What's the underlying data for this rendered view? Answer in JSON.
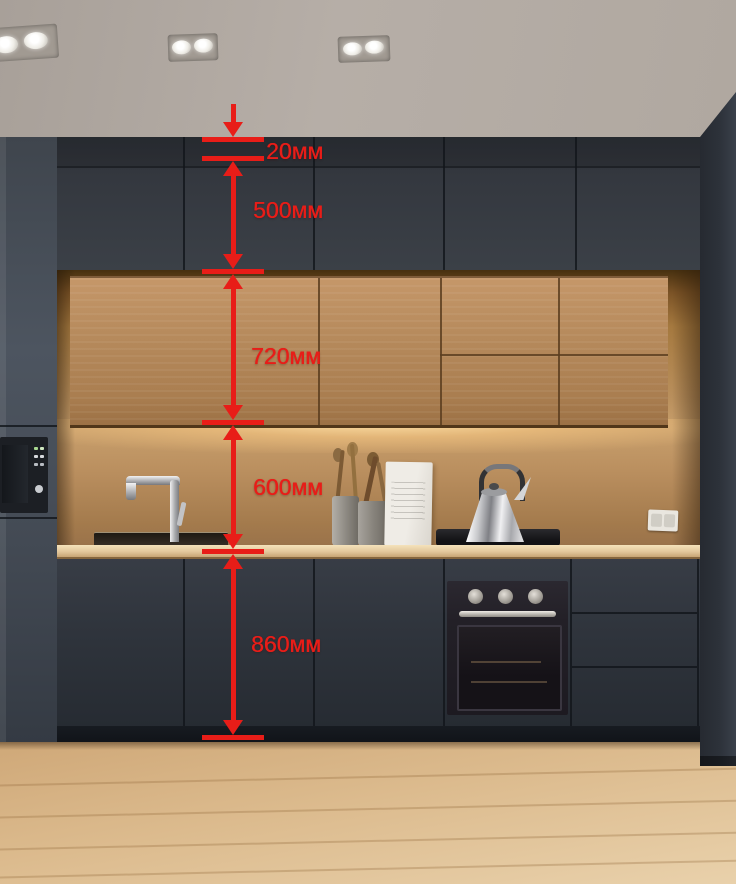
{
  "annotation": {
    "color": "#e81d18",
    "unit": "мм",
    "dimensions": [
      {
        "id": "crown-gap",
        "label": "20мм",
        "value": 20
      },
      {
        "id": "upper-cabinet-height",
        "label": "500мм",
        "value": 500
      },
      {
        "id": "wall-cabinet-height",
        "label": "720мм",
        "value": 720
      },
      {
        "id": "backsplash-height",
        "label": "600мм",
        "value": 600
      },
      {
        "id": "base-cabinet-height",
        "label": "860мм",
        "value": 860
      }
    ]
  },
  "palette": {
    "annotation_red": "#e81d18",
    "cabinet_dark": "#32373f",
    "wood_cabinet": "#b3875a",
    "backsplash_glow": "#f6cf96",
    "countertop": "#e5c99e",
    "floor": "#ddbc90",
    "ceiling": "#b2aaa3"
  }
}
